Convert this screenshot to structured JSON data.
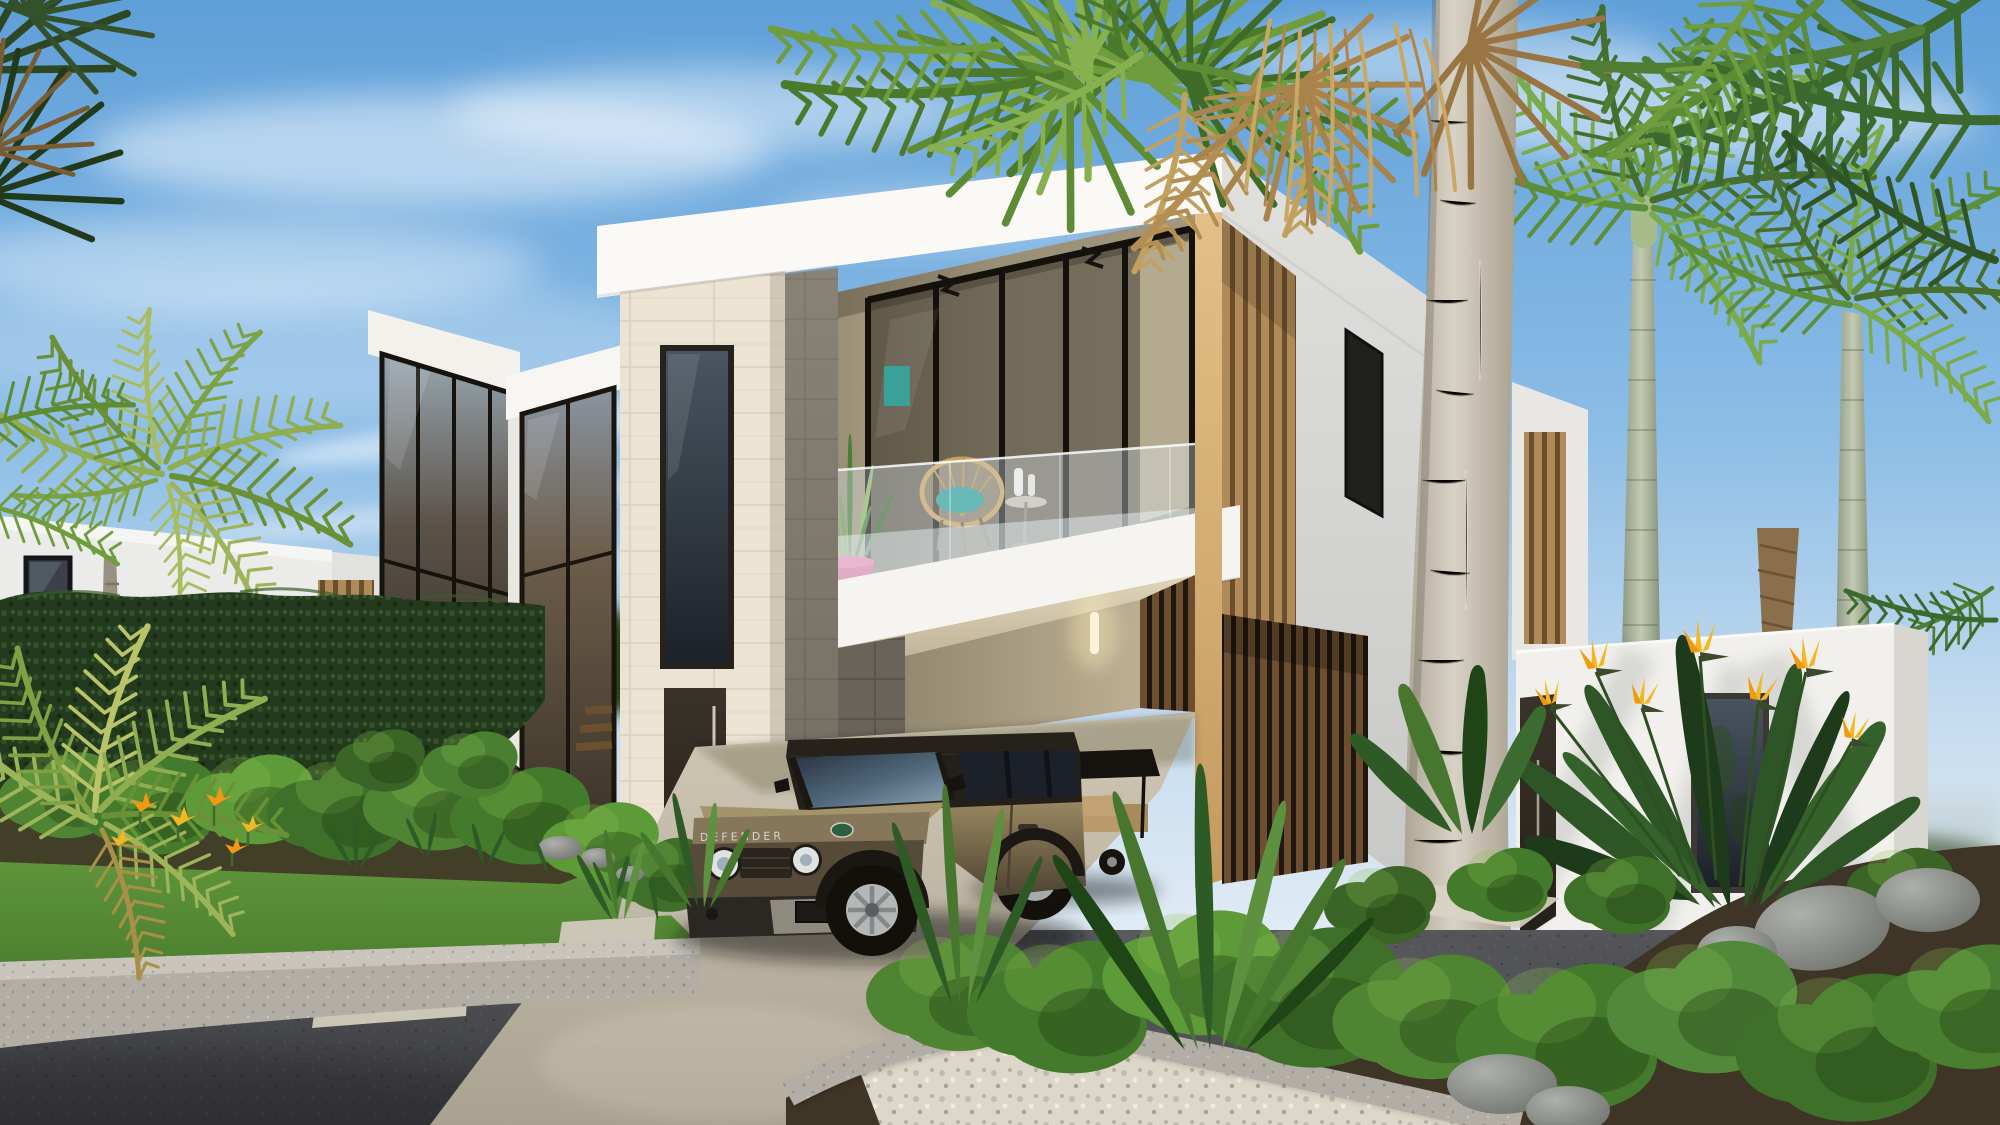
{
  "image": {
    "type": "3d-architectural-exterior-render",
    "subject": "Modern two-story white tropical villa with open carport, balcony and one-story side wing",
    "setting": "Daytime, clear blue sky with wispy clouds, tall palm trees, hedge and landscaped front yard, dark asphalt street with concrete curbs",
    "camera": "street-level three-quarter view"
  },
  "vehicle": {
    "type": "suv",
    "hood_text": "DEFENDER",
    "badge": "land-rover-green-oval-badge",
    "body_color": "#7a6b4c",
    "roof_color": "#26211b"
  },
  "second_vehicle": {
    "type": "golf-cart",
    "canopy_color": "#16130f",
    "body_color": "#c9cac8",
    "seat_color": "#c2a172"
  },
  "villa": {
    "floors": 2,
    "features": [
      "white-parapet-roofline",
      "travertine-entrance-tower",
      "narrow-bronze-window",
      "dark-entry-door",
      "glass-curtain-walls",
      "second-floor-balcony-with-glass-railing",
      "acapulco-wicker-chair",
      "snake-plant-in-pink-pot",
      "teal-cushion",
      "open-carport",
      "wood-louver-slat-cladding",
      "one-story-side-wing",
      "neighboring-white-villa-left"
    ]
  },
  "landscape": {
    "plants": [
      "royal-palms",
      "fan-palm-with-dried-fronds",
      "giant-pale-palm-trunk",
      "boxwood-bushes",
      "tall-hedge",
      "bird-of-paradise-flowers",
      "orange-heliconia-flowers",
      "strelitzia-blade-plants",
      "lawn",
      "white-gravel-planter",
      "gray-boulders"
    ],
    "hardscape": [
      "asphalt-road",
      "concrete-driveway",
      "speckled-concrete-curb",
      "stepping-stones"
    ]
  },
  "palette": {
    "skyTop": "#5f9fd8",
    "skyLow": "#c6dcef",
    "cloud": "#ffffff",
    "facade": "#f1f0ec",
    "band": "#faf9f5",
    "fascia": "#f5f4f0",
    "facadeShade": "#dcdcd8",
    "travertine": "#ebe2d1",
    "stoneGray": "#837d72",
    "cornerWood": "#d8b87e",
    "woodLight": "#b08a58",
    "woodDark": "#6d4f2f",
    "balconyWall": "#c7bca0",
    "teal": "#279d95",
    "potPink": "#c42b62",
    "chairTan": "#c9a05a",
    "glassBronze": "#4a4136",
    "glassDark": "#20242a",
    "windowFrame": "#1a1714",
    "hedge": "#243a1e",
    "lawn": "#5a8f3a",
    "bushGreen": "#4f8433",
    "mulch": "#3f3526",
    "palmGreen": "#5d8c34",
    "palmDark": "#3c6a2e",
    "palmYellow": "#9db45a",
    "dried": "#c2a05f",
    "trunkPale": "#cfc9bd",
    "royalTrunk": "#9aa78c",
    "asphalt": "#44454a",
    "concrete": "#c2bcae",
    "curb": "#b2aea6",
    "gravel": "#ddd8ca",
    "rock": "#909390",
    "distantHaze": "#9fb4bd",
    "doorDark": "#2e2822",
    "flowerYellow": "#f2b722",
    "flowerOrange": "#ef9a10",
    "suvBody": "#7a6b4c",
    "suvRoof": "#26211b",
    "suvText": "#d8d4c8",
    "cartCanopy": "#16130f",
    "cartBody": "#c9cac8",
    "seatTan": "#c2a172"
  }
}
